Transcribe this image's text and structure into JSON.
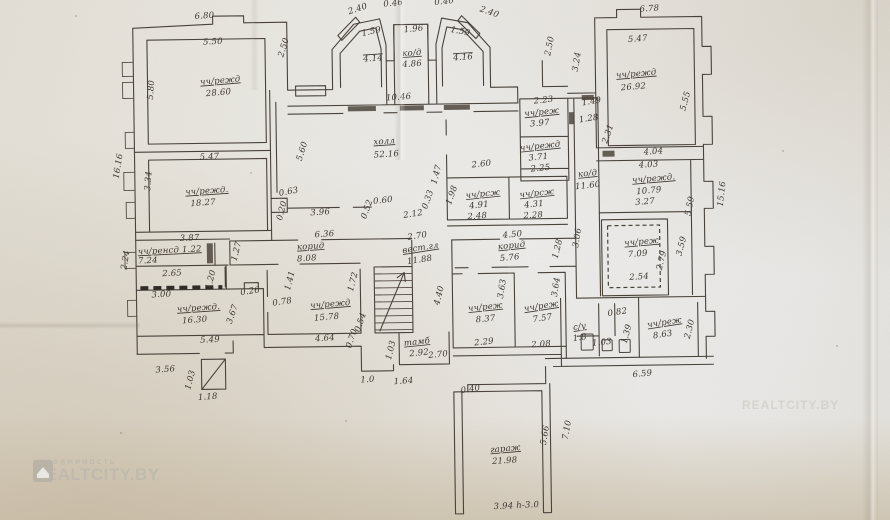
{
  "document": {
    "kind": "hand-drawn floor plan sheet (photographed technical passport drawing)",
    "language": "ru"
  },
  "watermark": {
    "brand_small": "НЕДВИЖИМОСТЬ",
    "brand_large": "REALTCITY.BY",
    "logo": "house-icon"
  },
  "colors": {
    "paper": "#e9e7e1",
    "paper_warm": "#d2c6ae",
    "ink": "#47413a",
    "watermark": "#c0baae"
  },
  "plan": {
    "rooms": [
      {
        "name": "чч/режд",
        "area": "28.60"
      },
      {
        "name": "чч/режд",
        "area": "26.92"
      },
      {
        "name": "чч/режд",
        "area": "18.27"
      },
      {
        "name": "чч/режд",
        "area": "16.30"
      },
      {
        "name": "чч/режд",
        "area": "15.78"
      },
      {
        "name": "чч/режд",
        "area": "10.79"
      },
      {
        "name": "чч/реж",
        "area": "8.63"
      },
      {
        "name": "чч/реж",
        "area": "8.37"
      },
      {
        "name": "чч/реж",
        "area": "7.57"
      },
      {
        "name": "чч/реж",
        "area": "7.09"
      },
      {
        "name": "чч/ренсд",
        "area": "7.24"
      },
      {
        "name": "чч/рсж",
        "area": "4.91"
      },
      {
        "name": "чч/рсж",
        "area": "4.31"
      },
      {
        "name": "чч/реж",
        "area": "3.97"
      },
      {
        "name": "чч/режд",
        "area": "3.71"
      },
      {
        "name": "холл",
        "area": "52.16"
      },
      {
        "name": "ко/д",
        "area": "4.86"
      },
      {
        "name": "ко/д",
        "area": "11.60"
      },
      {
        "name": "корид",
        "area": "8.08"
      },
      {
        "name": "корид",
        "area": "5.76"
      },
      {
        "name": "вест.гл",
        "area": "11.88"
      },
      {
        "name": "тамб",
        "area": "2.92"
      },
      {
        "name": "с/у",
        "area": "1.8"
      },
      {
        "name": "гараж",
        "area": "21.98"
      }
    ],
    "labels": [
      {
        "t": "6.80",
        "x": 208,
        "y": 15,
        "r": -3
      },
      {
        "t": "5.50",
        "x": 216,
        "y": 41,
        "r": -2
      },
      {
        "t": "5.80",
        "x": 156,
        "y": 86,
        "r": -85
      },
      {
        "t": "чч/режд",
        "x": 223,
        "y": 80,
        "r": -4,
        "u": 1
      },
      {
        "t": "28.60",
        "x": 221,
        "y": 92,
        "r": -4
      },
      {
        "t": "2.50",
        "x": 289,
        "y": 46,
        "r": -72
      },
      {
        "t": "2.40",
        "x": 362,
        "y": 10,
        "r": -18
      },
      {
        "t": "0.46",
        "x": 397,
        "y": 5,
        "r": -5,
        "s": 7
      },
      {
        "t": "0.40",
        "x": 448,
        "y": 4,
        "r": -5,
        "s": 7
      },
      {
        "t": "2.40",
        "x": 492,
        "y": 15,
        "r": 20
      },
      {
        "t": "1.59",
        "x": 375,
        "y": 33,
        "r": -12
      },
      {
        "t": "4.14",
        "x": 376,
        "y": 60,
        "r": -3,
        "o": 1
      },
      {
        "t": "1.96",
        "x": 417,
        "y": 31,
        "r": -5
      },
      {
        "t": "ко/д",
        "x": 415,
        "y": 55,
        "r": -3,
        "u": 1
      },
      {
        "t": "4.86",
        "x": 415,
        "y": 66,
        "r": -3
      },
      {
        "t": "1.59",
        "x": 463,
        "y": 34,
        "r": 12
      },
      {
        "t": "4.16",
        "x": 466,
        "y": 60,
        "r": -3,
        "o": 1
      },
      {
        "t": "10.46",
        "x": 401,
        "y": 99,
        "r": -3
      },
      {
        "t": "2.50",
        "x": 555,
        "y": 48,
        "r": -78
      },
      {
        "t": "3.24",
        "x": 582,
        "y": 64,
        "r": -80
      },
      {
        "t": "6.78",
        "x": 653,
        "y": 14,
        "r": -3
      },
      {
        "t": "5.47",
        "x": 641,
        "y": 44,
        "r": -4
      },
      {
        "t": "чч/режд",
        "x": 639,
        "y": 79,
        "r": -4,
        "u": 1
      },
      {
        "t": "26.92",
        "x": 636,
        "y": 92,
        "r": -4
      },
      {
        "t": "5.55",
        "x": 690,
        "y": 105,
        "r": -75
      },
      {
        "t": "16.16",
        "x": 122,
        "y": 162,
        "r": -80
      },
      {
        "t": "3.34",
        "x": 152,
        "y": 177,
        "r": -85
      },
      {
        "t": "5.47",
        "x": 211,
        "y": 156,
        "r": -2
      },
      {
        "t": "чч/режд.",
        "x": 208,
        "y": 190,
        "r": -3,
        "u": 1
      },
      {
        "t": "18.27",
        "x": 204,
        "y": 202,
        "r": -3
      },
      {
        "t": "5.60",
        "x": 306,
        "y": 150,
        "r": -72
      },
      {
        "t": "холл",
        "x": 386,
        "y": 143,
        "r": -3,
        "u": 1
      },
      {
        "t": "52.16",
        "x": 388,
        "y": 156,
        "r": -3
      },
      {
        "t": "0.63",
        "x": 290,
        "y": 192,
        "r": -10
      },
      {
        "t": "0.20",
        "x": 285,
        "y": 209,
        "r": -75,
        "s": 7
      },
      {
        "t": "3.96",
        "x": 321,
        "y": 213,
        "r": -3
      },
      {
        "t": "0.52",
        "x": 370,
        "y": 209,
        "r": -70,
        "s": 7
      },
      {
        "t": "0.60",
        "x": 384,
        "y": 202,
        "r": -5,
        "s": 7
      },
      {
        "t": "2.12",
        "x": 414,
        "y": 216,
        "r": -8
      },
      {
        "t": "2.60",
        "x": 483,
        "y": 167,
        "r": -5
      },
      {
        "t": "1.47",
        "x": 440,
        "y": 175,
        "r": -75,
        "s": 7
      },
      {
        "t": "0.33",
        "x": 431,
        "y": 200,
        "r": -70,
        "s": 7
      },
      {
        "t": "1.98",
        "x": 455,
        "y": 196,
        "r": -70
      },
      {
        "t": "чч/рсж",
        "x": 484,
        "y": 197,
        "r": -5,
        "u": 1
      },
      {
        "t": "4.91",
        "x": 480,
        "y": 208,
        "r": -5
      },
      {
        "t": "2.48",
        "x": 478,
        "y": 219,
        "r": -3
      },
      {
        "t": "чч/рсж",
        "x": 538,
        "y": 197,
        "r": -5,
        "u": 1
      },
      {
        "t": "4.31",
        "x": 535,
        "y": 208,
        "r": -5
      },
      {
        "t": "2.28",
        "x": 534,
        "y": 219,
        "r": -3
      },
      {
        "t": "2.23",
        "x": 546,
        "y": 104,
        "r": -5
      },
      {
        "t": "чч/реж",
        "x": 544,
        "y": 116,
        "r": -5,
        "u": 1
      },
      {
        "t": "3.97",
        "x": 542,
        "y": 127,
        "r": -5
      },
      {
        "t": "1.49",
        "x": 594,
        "y": 106,
        "r": -8
      },
      {
        "t": "1.28",
        "x": 591,
        "y": 123,
        "r": -8
      },
      {
        "t": "2.31",
        "x": 612,
        "y": 137,
        "r": -70
      },
      {
        "t": "чч/режд",
        "x": 542,
        "y": 150,
        "r": -5,
        "u": 1
      },
      {
        "t": "3.71",
        "x": 540,
        "y": 161,
        "r": -5
      },
      {
        "t": "2.25",
        "x": 542,
        "y": 172,
        "r": -5
      },
      {
        "t": "ко/д",
        "x": 589,
        "y": 178,
        "r": -5,
        "u": 1
      },
      {
        "t": "11.60",
        "x": 589,
        "y": 190,
        "r": -5
      },
      {
        "t": "4.04",
        "x": 655,
        "y": 157,
        "r": -3
      },
      {
        "t": "4.03",
        "x": 650,
        "y": 170,
        "r": -3
      },
      {
        "t": "чч/режд.",
        "x": 655,
        "y": 184,
        "r": -4,
        "u": 1
      },
      {
        "t": "10.79",
        "x": 650,
        "y": 196,
        "r": -4
      },
      {
        "t": "3.27",
        "x": 646,
        "y": 207,
        "r": -4
      },
      {
        "t": "5.59",
        "x": 693,
        "y": 210,
        "r": -78
      },
      {
        "t": "15.16",
        "x": 725,
        "y": 198,
        "r": -83
      },
      {
        "t": "чч/реж",
        "x": 642,
        "y": 247,
        "r": -4,
        "u": 1
      },
      {
        "t": "7.09",
        "x": 638,
        "y": 259,
        "r": -4
      },
      {
        "t": "2.79",
        "x": 664,
        "y": 264,
        "r": -75
      },
      {
        "t": "3.59",
        "x": 684,
        "y": 250,
        "r": -75
      },
      {
        "t": "2.54",
        "x": 639,
        "y": 282,
        "r": -3
      },
      {
        "t": "0.82",
        "x": 617,
        "y": 317,
        "r": -8
      },
      {
        "t": "с/у",
        "x": 579,
        "y": 331,
        "r": -8,
        "u": 1
      },
      {
        "t": "1.8",
        "x": 579,
        "y": 342,
        "r": -8
      },
      {
        "t": "1.03",
        "x": 601,
        "y": 347,
        "r": -5,
        "s": 7
      },
      {
        "t": "1.39",
        "x": 628,
        "y": 337,
        "r": -75
      },
      {
        "t": "чч/реж",
        "x": 664,
        "y": 328,
        "r": -8,
        "u": 1
      },
      {
        "t": "8.63",
        "x": 662,
        "y": 340,
        "r": -8
      },
      {
        "t": "2.30",
        "x": 691,
        "y": 333,
        "r": -75
      },
      {
        "t": "6.59",
        "x": 641,
        "y": 379,
        "r": -5
      },
      {
        "t": "3.87",
        "x": 190,
        "y": 237,
        "r": -2
      },
      {
        "t": "чч/ренсд 1.22",
        "x": 170,
        "y": 249,
        "r": -2,
        "u": 1
      },
      {
        "t": "7.24",
        "x": 148,
        "y": 259,
        "r": -2
      },
      {
        "t": "2.24",
        "x": 128,
        "y": 256,
        "r": -80
      },
      {
        "t": "2.65",
        "x": 172,
        "y": 272,
        "r": -2
      },
      {
        "t": "3.00",
        "x": 161,
        "y": 293,
        "r": -2
      },
      {
        "t": "чч/режд.",
        "x": 198,
        "y": 307,
        "r": -3,
        "u": 1
      },
      {
        "t": "16.30",
        "x": 194,
        "y": 319,
        "r": -3
      },
      {
        "t": "0.26",
        "x": 250,
        "y": 291,
        "r": -8
      },
      {
        "t": "1.20",
        "x": 213,
        "y": 277,
        "r": -75,
        "s": 7
      },
      {
        "t": "3.67",
        "x": 234,
        "y": 312,
        "r": -70
      },
      {
        "t": "1.27",
        "x": 239,
        "y": 249,
        "r": -75
      },
      {
        "t": "6.36",
        "x": 325,
        "y": 235,
        "r": -3
      },
      {
        "t": "корид",
        "x": 311,
        "y": 247,
        "r": -3,
        "u": 1
      },
      {
        "t": "8.08",
        "x": 307,
        "y": 259,
        "r": -3
      },
      {
        "t": "0.78",
        "x": 282,
        "y": 302,
        "r": -8
      },
      {
        "t": "1.41",
        "x": 292,
        "y": 279,
        "r": -75,
        "s": 7
      },
      {
        "t": "чч/режд",
        "x": 330,
        "y": 305,
        "r": -4,
        "u": 1
      },
      {
        "t": "15.78",
        "x": 326,
        "y": 318,
        "r": -4
      },
      {
        "t": "1.72",
        "x": 355,
        "y": 281,
        "r": -75
      },
      {
        "t": "0.54",
        "x": 362,
        "y": 322,
        "r": -70,
        "s": 7
      },
      {
        "t": "0.70",
        "x": 353,
        "y": 338,
        "r": -70,
        "s": 7
      },
      {
        "t": "4.64",
        "x": 324,
        "y": 339,
        "r": -3
      },
      {
        "t": "5.49",
        "x": 209,
        "y": 339,
        "r": -2
      },
      {
        "t": "3.56",
        "x": 164,
        "y": 368,
        "r": -3
      },
      {
        "t": "1.03",
        "x": 191,
        "y": 377,
        "r": -75
      },
      {
        "t": "1.18",
        "x": 206,
        "y": 396,
        "r": -3
      },
      {
        "t": "2.70",
        "x": 418,
        "y": 238,
        "r": -8
      },
      {
        "t": "вест.гл",
        "x": 421,
        "y": 250,
        "r": -8,
        "u": 1
      },
      {
        "t": "11.88",
        "x": 420,
        "y": 262,
        "r": -8
      },
      {
        "t": "4.50",
        "x": 513,
        "y": 238,
        "r": -5
      },
      {
        "t": "корид",
        "x": 512,
        "y": 249,
        "r": -5,
        "u": 1
      },
      {
        "t": "5.76",
        "x": 510,
        "y": 261,
        "r": -5
      },
      {
        "t": "1.28",
        "x": 560,
        "y": 251,
        "r": -75
      },
      {
        "t": "3.06",
        "x": 580,
        "y": 240,
        "r": -80
      },
      {
        "t": "4.40",
        "x": 441,
        "y": 296,
        "r": -75
      },
      {
        "t": "3.63",
        "x": 504,
        "y": 290,
        "r": -80
      },
      {
        "t": "чч/реж",
        "x": 485,
        "y": 310,
        "r": -5,
        "u": 1
      },
      {
        "t": "8.37",
        "x": 485,
        "y": 322,
        "r": -5
      },
      {
        "t": "2.29",
        "x": 483,
        "y": 345,
        "r": -5
      },
      {
        "t": "чч/реж",
        "x": 541,
        "y": 310,
        "r": -8,
        "u": 1
      },
      {
        "t": "7.57",
        "x": 542,
        "y": 322,
        "r": -8
      },
      {
        "t": "2.08",
        "x": 540,
        "y": 348,
        "r": -3
      },
      {
        "t": "3.64",
        "x": 558,
        "y": 289,
        "r": -80
      },
      {
        "t": "тамб",
        "x": 416,
        "y": 344,
        "r": -5,
        "u": 1
      },
      {
        "t": "2.92",
        "x": 418,
        "y": 355,
        "r": -5
      },
      {
        "t": "2.70",
        "x": 437,
        "y": 357,
        "r": -5
      },
      {
        "t": "1.03",
        "x": 392,
        "y": 350,
        "r": -75
      },
      {
        "t": "1.0",
        "x": 366,
        "y": 381,
        "r": -3
      },
      {
        "t": "1.64",
        "x": 402,
        "y": 383,
        "r": -3
      },
      {
        "t": "0.40",
        "x": 469,
        "y": 392,
        "r": -8
      },
      {
        "t": "гараж",
        "x": 503,
        "y": 452,
        "r": -4,
        "u": 1
      },
      {
        "t": "21.98",
        "x": 502,
        "y": 464,
        "r": -3
      },
      {
        "t": "5.66",
        "x": 545,
        "y": 437,
        "r": -80
      },
      {
        "t": "7.10",
        "x": 567,
        "y": 432,
        "r": -80
      },
      {
        "t": "3.94 h-3.0",
        "x": 513,
        "y": 509,
        "r": -2
      }
    ]
  }
}
